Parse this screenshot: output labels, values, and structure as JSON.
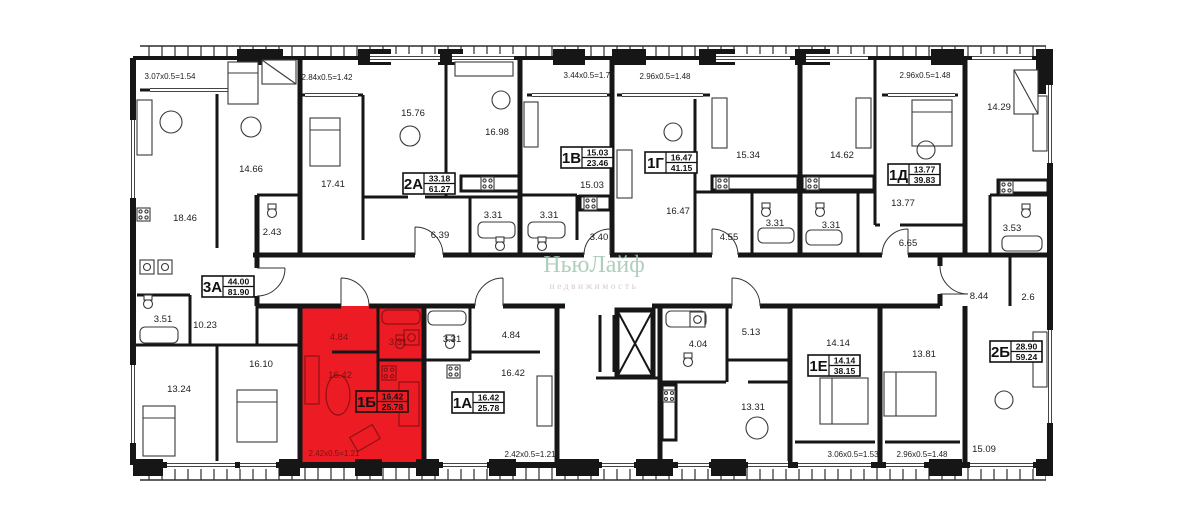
{
  "watermark": {
    "line1": "НьюЛайф",
    "line2": "недвижимость"
  },
  "highlight_color": "#ed1c24",
  "units": [
    {
      "id": "3А",
      "living": "44.00",
      "total": "81.90",
      "highlighted": false,
      "balcony": "3.07x0.5=1.54",
      "rooms": {
        "kitchen_living": "18.46",
        "bedroom1": "14.66",
        "wc": "2.43",
        "bath": "3.51",
        "hall": "10.23",
        "bedroom2": "13.24",
        "bedroom3": "16.10"
      }
    },
    {
      "id": "2А",
      "living": "33.18",
      "total": "61.27",
      "highlighted": false,
      "balcony": "2.84x0.5=1.42",
      "rooms": {
        "bedroom1": "17.41",
        "bedroom2": "15.76",
        "kitchen_living": "16.98",
        "hall": "6.39",
        "bath": "3.31"
      }
    },
    {
      "id": "1В",
      "living": "15.03",
      "total": "23.46",
      "highlighted": false,
      "balcony": "3.44x0.5=1.72",
      "rooms": {
        "kitchen_living": "15.03",
        "bath": "3.31",
        "hall": "3.40"
      }
    },
    {
      "id": "1Г",
      "living": "16.47",
      "total": "41.15",
      "highlighted": false,
      "balcony": "2.96x0.5=1.48",
      "rooms": {
        "living": "16.47",
        "kitchen": "15.34",
        "hall": "4.55",
        "bath": "3.31"
      }
    },
    {
      "id": "1Д",
      "living": "13.77",
      "total": "39.83",
      "highlighted": false,
      "balcony": "2.96x0.5=1.48",
      "rooms": {
        "kitchen": "14.62",
        "living": "13.77",
        "bath": "3.31",
        "hall": "6.65"
      }
    },
    {
      "id": "1Б",
      "living": "16.42",
      "total": "25.78",
      "highlighted": true,
      "balcony": "2.42x0.5=1.21",
      "rooms": {
        "hall": "4.84",
        "bath": "3.31",
        "kitchen_living": "16.42"
      }
    },
    {
      "id": "1А",
      "living": "16.42",
      "total": "25.78",
      "highlighted": false,
      "balcony": "2.42x0.5=1.21",
      "rooms": {
        "bath": "3.31",
        "hall": "4.84",
        "kitchen_living": "16.42"
      }
    },
    {
      "id": "1Е",
      "living": "14.14",
      "total": "38.15",
      "highlighted": false,
      "balcony": "3.06x0.5=1.53",
      "rooms": {
        "bath": "4.04",
        "hall": "5.13",
        "kitchen_living": "13.31",
        "bedroom": "14.14"
      }
    },
    {
      "id": "2Б",
      "living": "28.90",
      "total": "59.24",
      "highlighted": false,
      "balcony": "2.96x0.5=1.48",
      "rooms": {
        "kitchen": "14.29",
        "bath": "3.53",
        "hall": "8.44",
        "storage": "2.6",
        "bedroom": "13.81",
        "living": "15.09"
      }
    }
  ]
}
